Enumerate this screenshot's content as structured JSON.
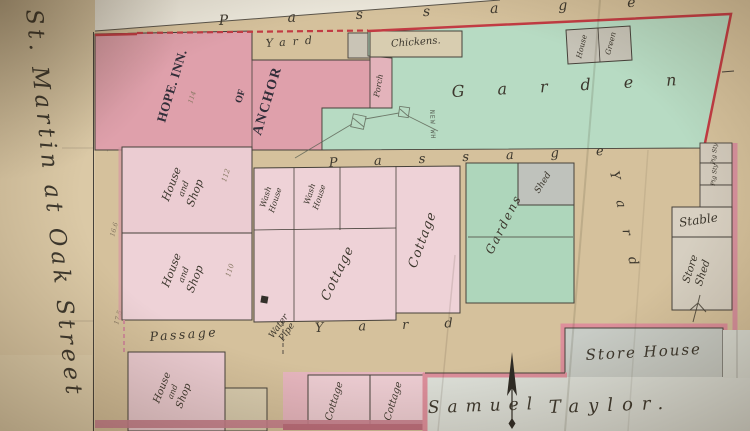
{
  "street": {
    "name": "St. Martin at Oak Street"
  },
  "passages": {
    "top": "Passage",
    "middle": "Passage",
    "bottom": "Passage"
  },
  "open_areas": {
    "garden": "Garden",
    "gardens": "Gardens",
    "yard_top": "Yard",
    "yard_east": "Yard",
    "yard_bottom": "Yard"
  },
  "owner": {
    "first": "Samuel",
    "last": "Taylor."
  },
  "inn": {
    "line1": "ANCHOR",
    "line2": "OF",
    "line3": "HOPE. INN."
  },
  "buildings": {
    "chickens": "Chickens.",
    "porch": "Porch",
    "green_house": {
      "l1": "Green",
      "l2": "House"
    },
    "new_wh": "NEW WH",
    "wash_house": {
      "l1": "Wash",
      "l2": "House"
    },
    "house_and_shop": {
      "l1": "House",
      "l2": "and",
      "l3": "Shop"
    },
    "cottage": "Cottage",
    "shed": "Shed",
    "pig_sty": "Pig Sty",
    "stable": "Stable",
    "store_shed": {
      "l1": "Store",
      "l2": "Shed"
    },
    "store_house": "Store House",
    "water_pipe": {
      "l1": "Water",
      "l2": "Pipe"
    }
  },
  "annotations": {
    "no_114": "114",
    "no_112": "112",
    "no_110": "110",
    "m1": "12.1",
    "m2": "16.6",
    "m3": "17.5"
  },
  "colors": {
    "paper": "#d5c19c",
    "pink_dark": "#dfa0ab",
    "pink_light": "#ecd0d5",
    "green": "#b7dbc3",
    "grey_building": "#c9c6ba",
    "red_line": "#c23b43",
    "pink_line": "#dd8f9b",
    "ink": "#46413a"
  }
}
